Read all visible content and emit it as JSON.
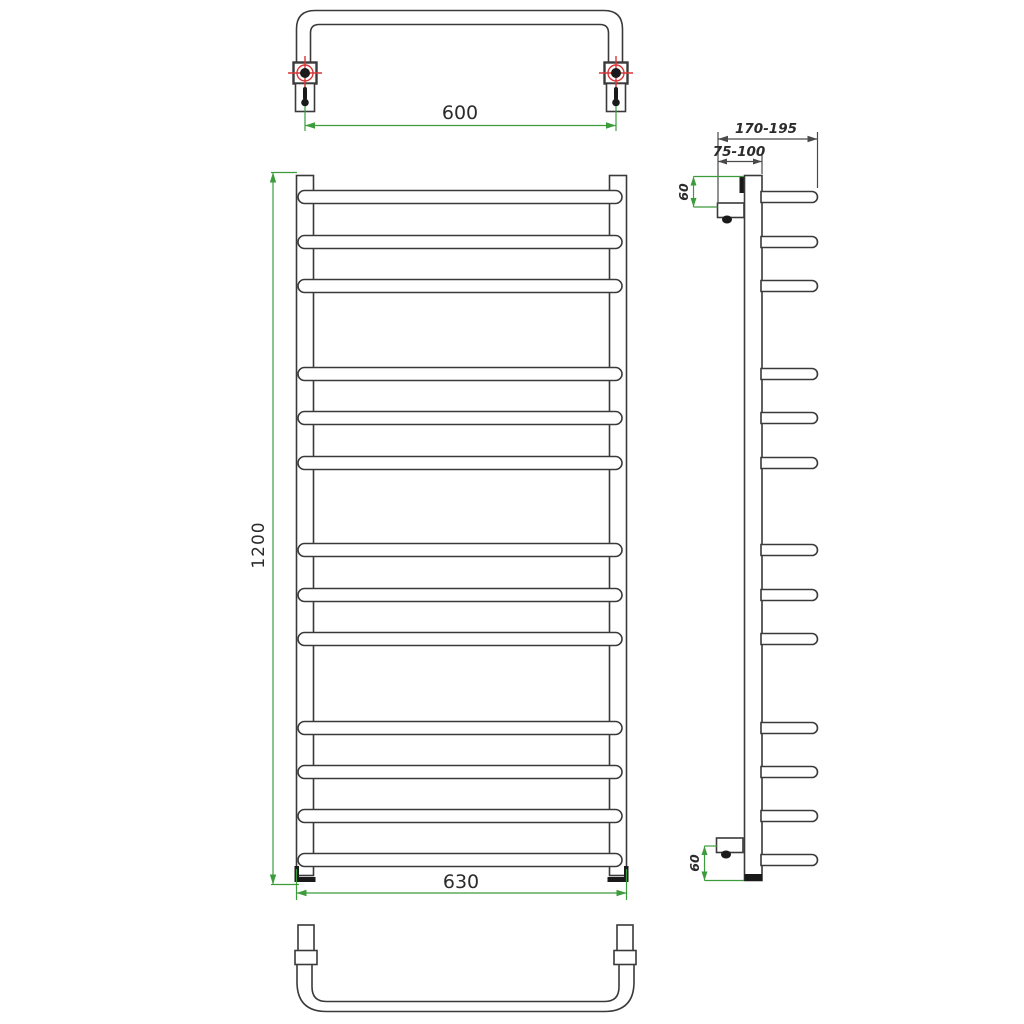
{
  "canvas": {
    "background": "#ffffff"
  },
  "colors": {
    "drawing_line": "#3a3a3a",
    "dimension_line": "#3c9c3c",
    "dimension_dark": "#4a4a4a",
    "mount_accent_red": "#d93636",
    "label_text": "#2b2b2b",
    "fill_black": "#1a1a1a"
  },
  "views": {
    "top": {
      "mount_spacing_label": "600"
    },
    "front": {
      "height_label": "1200",
      "width_label": "630",
      "rung_count": 13
    },
    "side": {
      "total_depth_label": "170-195",
      "bracket_depth_label": "75-100",
      "top_offset_label": "60",
      "bottom_offset_label": "60",
      "rung_count": 13
    }
  }
}
